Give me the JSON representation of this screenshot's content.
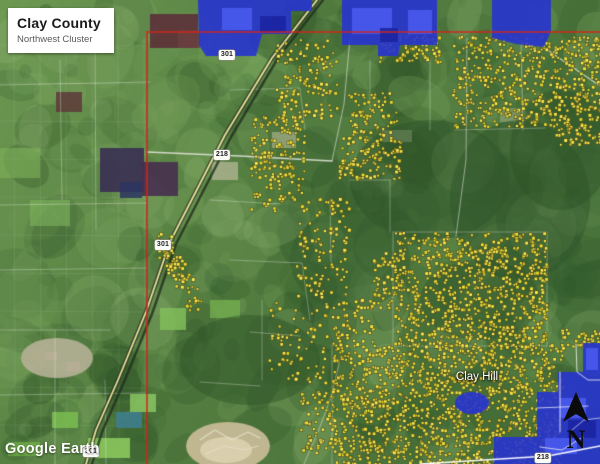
{
  "header": {
    "title": "Clay County",
    "subtitle": "Northwest Cluster"
  },
  "watermark": {
    "logo_text": "Google Earth"
  },
  "map": {
    "place_labels": [
      {
        "text": "Clay Hill",
        "x": 477,
        "y": 377
      }
    ],
    "route_shields": [
      {
        "label": "301",
        "x": 227,
        "y": 55
      },
      {
        "label": "218",
        "x": 222,
        "y": 155
      },
      {
        "label": "301",
        "x": 163,
        "y": 245
      },
      {
        "label": "301",
        "x": 91,
        "y": 452
      },
      {
        "label": "218",
        "x": 543,
        "y": 458
      }
    ],
    "north": {
      "label": "N"
    },
    "colors": {
      "boundary": "#d2251a",
      "overlay": "#2734cf",
      "overlay_light": "#4a5cf0",
      "overlay_dark": "#1a23a0",
      "parcel_fill": "#f4e53a",
      "parcel_edge": "#55511c"
    },
    "boundary_lines": [
      {
        "points": [
          [
            147,
            32
          ],
          [
            600,
            32
          ]
        ]
      },
      {
        "points": [
          [
            147,
            32
          ],
          [
            147,
            464
          ]
        ]
      }
    ],
    "overlays": [
      {
        "points": [
          [
            198,
            0
          ],
          [
            291,
            0
          ],
          [
            291,
            34
          ],
          [
            262,
            34
          ],
          [
            256,
            56
          ],
          [
            206,
            56
          ],
          [
            199,
            45
          ]
        ]
      },
      {
        "points": [
          [
            291,
            0
          ],
          [
            312,
            0
          ],
          [
            312,
            11
          ],
          [
            291,
            11
          ]
        ]
      },
      {
        "points": [
          [
            342,
            0
          ],
          [
            437,
            0
          ],
          [
            437,
            45
          ],
          [
            400,
            45
          ],
          [
            398,
            56
          ],
          [
            378,
            56
          ],
          [
            378,
            45
          ],
          [
            342,
            45
          ]
        ]
      },
      {
        "points": [
          [
            492,
            0
          ],
          [
            551,
            0
          ],
          [
            551,
            31
          ],
          [
            544,
            47
          ],
          [
            516,
            44
          ],
          [
            492,
            38
          ]
        ]
      },
      {
        "points": [
          [
            583,
            343
          ],
          [
            600,
            343
          ],
          [
            600,
            464
          ],
          [
            494,
            464
          ],
          [
            494,
            437
          ],
          [
            537,
            437
          ],
          [
            537,
            392
          ],
          [
            558,
            392
          ],
          [
            558,
            372
          ],
          [
            583,
            372
          ]
        ]
      },
      {
        "ellipse": [
          472,
          403,
          17,
          11
        ]
      }
    ],
    "overlay_patches": [
      {
        "rect": [
          222,
          8,
          30,
          22
        ],
        "tone": "light"
      },
      {
        "rect": [
          352,
          8,
          40,
          26
        ],
        "tone": "light"
      },
      {
        "rect": [
          408,
          10,
          24,
          24
        ],
        "tone": "light"
      },
      {
        "rect": [
          560,
          398,
          26,
          20
        ],
        "tone": "light"
      },
      {
        "rect": [
          545,
          438,
          32,
          16
        ],
        "tone": "light"
      },
      {
        "rect": [
          586,
          348,
          12,
          22
        ],
        "tone": "light"
      },
      {
        "rect": [
          260,
          16,
          26,
          16
        ],
        "tone": "dark"
      },
      {
        "rect": [
          380,
          28,
          18,
          14
        ],
        "tone": "dark"
      },
      {
        "rect": [
          568,
          420,
          28,
          18
        ],
        "tone": "dark"
      }
    ],
    "overlay_roads": [
      {
        "points": [
          [
            560,
            372
          ],
          [
            560,
            432
          ]
        ],
        "width": 1,
        "alpha": 0.8
      },
      {
        "points": [
          [
            537,
            408
          ],
          [
            588,
            406
          ]
        ],
        "width": 1,
        "alpha": 0.7
      },
      {
        "points": [
          [
            576,
            344
          ],
          [
            577,
            372
          ],
          [
            588,
            380
          ],
          [
            600,
            380
          ]
        ],
        "width": 1,
        "alpha": 0.75
      },
      {
        "points": [
          [
            583,
            437
          ],
          [
            562,
            450
          ],
          [
            540,
            447
          ]
        ],
        "width": 1,
        "alpha": 0.7
      },
      {
        "points": [
          [
            600,
            418
          ],
          [
            584,
            420
          ],
          [
            572,
            430
          ]
        ],
        "width": 1,
        "alpha": 0.6
      },
      {
        "points": [
          [
            420,
            464
          ],
          [
            500,
            459
          ],
          [
            548,
            456
          ],
          [
            600,
            446
          ]
        ],
        "width": 1.6,
        "alpha": 0.95
      }
    ],
    "roads": [
      {
        "points": [
          [
            317,
            0
          ],
          [
            272,
            58
          ],
          [
            225,
            135
          ],
          [
            170,
            242
          ],
          [
            146,
            312
          ],
          [
            118,
            380
          ],
          [
            96,
            430
          ],
          [
            86,
            464
          ]
        ],
        "color": "#2e3524",
        "width": 4.5,
        "alpha": 0.75
      },
      {
        "points": [
          [
            323,
            0
          ],
          [
            278,
            58
          ],
          [
            231,
            137
          ],
          [
            176,
            244
          ],
          [
            152,
            314
          ],
          [
            124,
            382
          ],
          [
            102,
            432
          ],
          [
            92,
            464
          ]
        ],
        "color": "#22301e",
        "width": 2.5,
        "alpha": 0.8
      },
      {
        "points": [
          [
            317,
            0
          ],
          [
            272,
            58
          ],
          [
            225,
            135
          ],
          [
            170,
            242
          ],
          [
            146,
            312
          ],
          [
            118,
            380
          ],
          [
            96,
            430
          ],
          [
            86,
            464
          ]
        ],
        "color": "#efe7a0",
        "width": 1.8,
        "alpha": 0.95
      },
      {
        "points": [
          [
            147,
            152
          ],
          [
            240,
            156
          ],
          [
            332,
            161
          ]
        ],
        "color": "#e8e8e0",
        "width": 1.4,
        "alpha": 0.85
      },
      {
        "points": [
          [
            332,
            161
          ],
          [
            344,
            104
          ],
          [
            350,
            38
          ]
        ],
        "color": "#e8e8e0",
        "width": 1,
        "alpha": 0.6
      },
      {
        "points": [
          [
            467,
            38
          ],
          [
            466,
            160
          ],
          [
            456,
            236
          ]
        ],
        "color": "#e8e8e0",
        "width": 1,
        "alpha": 0.55
      },
      {
        "points": [
          [
            521,
            40
          ],
          [
            523,
            130
          ]
        ],
        "color": "#e8e8e0",
        "width": 1,
        "alpha": 0.5
      },
      {
        "points": [
          [
            543,
            47
          ],
          [
            600,
            86
          ]
        ],
        "color": "#e8e8e0",
        "width": 1.2,
        "alpha": 0.8
      },
      {
        "points": [
          [
            340,
            360
          ],
          [
            330,
            400
          ],
          [
            318,
            432
          ],
          [
            304,
            464
          ]
        ],
        "color": "#e8e8e0",
        "width": 1,
        "alpha": 0.5
      },
      {
        "points": [
          [
            200,
            440
          ],
          [
            215,
            430
          ],
          [
            232,
            440
          ],
          [
            248,
            432
          ],
          [
            260,
            438
          ]
        ],
        "color": "#e6e0cc",
        "width": 1.2,
        "alpha": 0.85
      },
      {
        "points": [
          [
            206,
            454
          ],
          [
            224,
            446
          ],
          [
            244,
            450
          ],
          [
            258,
            446
          ]
        ],
        "color": "#e6e0cc",
        "width": 1.2,
        "alpha": 0.8
      }
    ],
    "parcel_lines": [
      [
        [
          0,
          85
        ],
        [
          150,
          82
        ]
      ],
      [
        [
          0,
          205
        ],
        [
          147,
          203
        ]
      ],
      [
        [
          0,
          270
        ],
        [
          147,
          268
        ]
      ],
      [
        [
          0,
          330
        ],
        [
          110,
          330
        ]
      ],
      [
        [
          60,
          60
        ],
        [
          62,
          200
        ]
      ],
      [
        [
          95,
          40
        ],
        [
          96,
          230
        ]
      ],
      [
        [
          0,
          395
        ],
        [
          145,
          393
        ]
      ],
      [
        [
          55,
          330
        ],
        [
          55,
          464
        ]
      ],
      [
        [
          105,
          380
        ],
        [
          106,
          464
        ]
      ],
      [
        [
          230,
          90
        ],
        [
          300,
          88
        ],
        [
          305,
          130
        ]
      ],
      [
        [
          210,
          200
        ],
        [
          280,
          204
        ]
      ],
      [
        [
          230,
          260
        ],
        [
          302,
          263
        ],
        [
          310,
          320
        ]
      ],
      [
        [
          250,
          332
        ],
        [
          300,
          336
        ]
      ],
      [
        [
          262,
          300
        ],
        [
          262,
          380
        ]
      ],
      [
        [
          200,
          382
        ],
        [
          260,
          386
        ]
      ],
      [
        [
          330,
          200
        ],
        [
          331,
          262
        ]
      ],
      [
        [
          390,
          180
        ],
        [
          390,
          232
        ]
      ],
      [
        [
          350,
          180
        ],
        [
          390,
          180
        ]
      ],
      [
        [
          393,
          232
        ],
        [
          547,
          232
        ],
        [
          547,
          346
        ],
        [
          393,
          346
        ],
        [
          393,
          232
        ]
      ],
      [
        [
          455,
          130
        ],
        [
          545,
          128
        ]
      ],
      [
        [
          332,
          344
        ],
        [
          332,
          464
        ]
      ],
      [
        [
          430,
          60
        ],
        [
          430,
          130
        ]
      ],
      [
        [
          370,
          60
        ],
        [
          370,
          110
        ]
      ]
    ],
    "parcel_clusters": [
      {
        "type": "rect",
        "x": 275,
        "y": 38,
        "w": 62,
        "h": 80,
        "count": 130
      },
      {
        "type": "rect",
        "x": 452,
        "y": 36,
        "w": 148,
        "h": 90,
        "count": 520
      },
      {
        "type": "rect",
        "x": 555,
        "y": 122,
        "w": 45,
        "h": 22,
        "count": 45
      },
      {
        "type": "rect",
        "x": 378,
        "y": 33,
        "w": 62,
        "h": 28,
        "count": 80
      },
      {
        "type": "rect",
        "x": 250,
        "y": 115,
        "w": 54,
        "h": 95,
        "count": 160
      },
      {
        "type": "rect",
        "x": 338,
        "y": 136,
        "w": 62,
        "h": 42,
        "count": 110
      },
      {
        "type": "rect",
        "x": 348,
        "y": 92,
        "w": 48,
        "h": 42,
        "count": 70
      },
      {
        "type": "rect",
        "x": 296,
        "y": 198,
        "w": 52,
        "h": 98,
        "count": 110
      },
      {
        "type": "band",
        "x1": 160,
        "y1": 238,
        "x2": 195,
        "y2": 305,
        "width": 18,
        "count": 85
      },
      {
        "type": "rect",
        "x": 394,
        "y": 232,
        "w": 152,
        "h": 114,
        "count": 780
      },
      {
        "type": "rect",
        "x": 372,
        "y": 252,
        "w": 26,
        "h": 55,
        "count": 50
      },
      {
        "type": "rect",
        "x": 332,
        "y": 344,
        "w": 230,
        "h": 120,
        "count": 1250
      },
      {
        "type": "rect",
        "x": 300,
        "y": 390,
        "w": 36,
        "h": 62,
        "count": 70
      },
      {
        "type": "rect",
        "x": 268,
        "y": 300,
        "w": 58,
        "h": 82,
        "count": 70
      },
      {
        "type": "rect",
        "x": 330,
        "y": 298,
        "w": 42,
        "h": 48,
        "count": 55
      },
      {
        "type": "rect",
        "x": 558,
        "y": 328,
        "w": 42,
        "h": 18,
        "count": 35
      }
    ]
  }
}
